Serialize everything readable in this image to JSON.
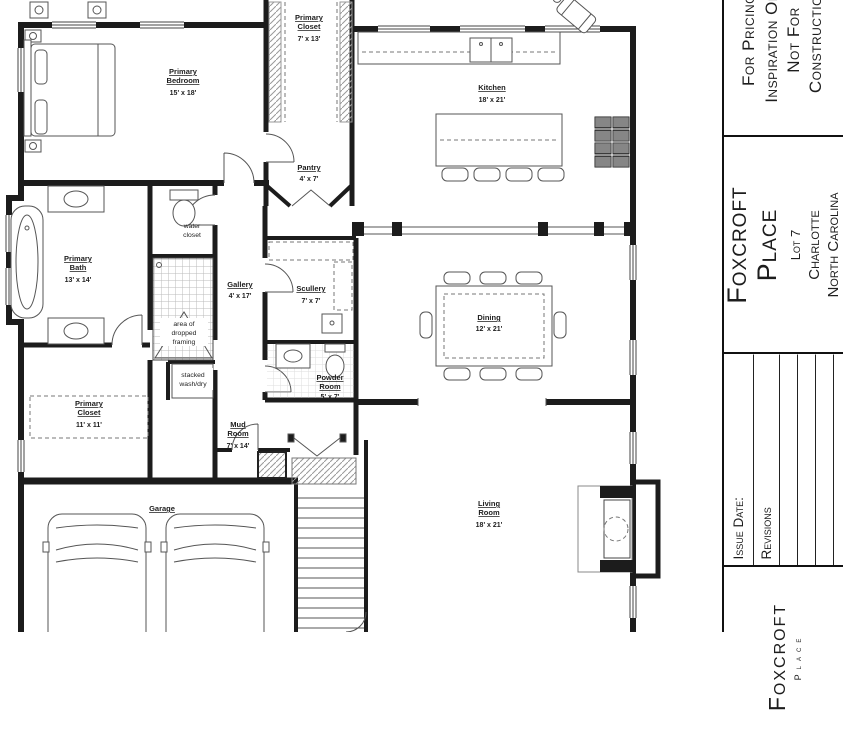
{
  "plan": {
    "rooms": [
      {
        "lines": [
          "Primary",
          "Bedroom"
        ],
        "dims": "15' x 18'"
      },
      {
        "lines": [
          "Primary",
          "Closet"
        ],
        "dims": "7' x 13'"
      },
      {
        "lines": [
          "Kitchen"
        ],
        "dims": "18' x 21'"
      },
      {
        "lines": [
          "Pantry"
        ],
        "dims": "4' x 7'"
      },
      {
        "lines": [
          "water",
          "closet"
        ],
        "dims": ""
      },
      {
        "lines": [
          "Primary",
          "Bath"
        ],
        "dims": "13' x 14'"
      },
      {
        "lines": [
          "Gallery"
        ],
        "dims": "4' x 17'"
      },
      {
        "lines": [
          "Scullery"
        ],
        "dims": "7' x 7'"
      },
      {
        "lines": [
          "area of",
          "dropped",
          "framing"
        ],
        "dims": ""
      },
      {
        "lines": [
          "stacked",
          "wash/dry"
        ],
        "dims": ""
      },
      {
        "lines": [
          "Powder",
          "Room"
        ],
        "dims": "5' x 7'"
      },
      {
        "lines": [
          "Primary",
          "Closet"
        ],
        "dims": "11' x 11'"
      },
      {
        "lines": [
          "Mud",
          "Room"
        ],
        "dims": "7' x 14'"
      },
      {
        "lines": [
          "Dining"
        ],
        "dims": "12' x 21'"
      },
      {
        "lines": [
          "Living",
          "Room"
        ],
        "dims": "18' x 21'"
      },
      {
        "lines": [
          "Garage"
        ],
        "dims": ""
      }
    ]
  },
  "title_block": {
    "disclaimer_lines": [
      "For Pricing",
      "Inspiration Only",
      "Not For",
      "Construction"
    ],
    "project": {
      "name_line1": "Foxcroft",
      "name_line2": "Place",
      "lot": "Lot 7",
      "city": "Charlotte",
      "state": "North Carolina"
    },
    "revisions": {
      "issue_date_label": "Issue Date:",
      "revisions_label": "Revisions"
    },
    "footer": {
      "logo_line1": "Foxcroft",
      "logo_line2": "Place"
    }
  },
  "colors": {
    "ink": "#1d1d1d",
    "paper": "#ffffff"
  }
}
